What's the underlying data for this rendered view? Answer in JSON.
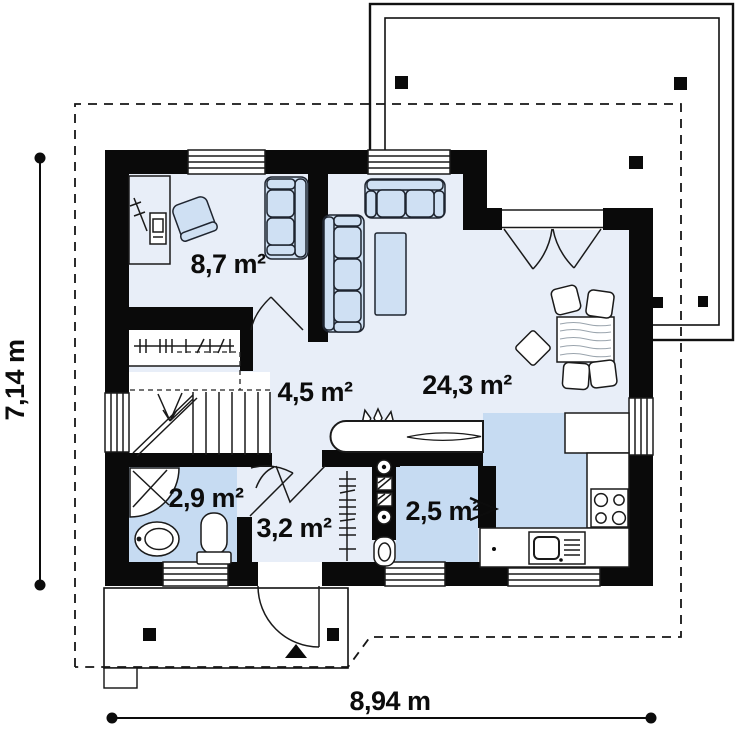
{
  "plan": {
    "type": "floor-plan",
    "rooms": [
      {
        "id": "office",
        "area_label": "8,7 m²"
      },
      {
        "id": "hall",
        "area_label": "4,5 m²"
      },
      {
        "id": "living-room",
        "area_label": "24,3 m²"
      },
      {
        "id": "bathroom",
        "area_label": "2,9 m²"
      },
      {
        "id": "vestibule",
        "area_label": "3,2 m²"
      },
      {
        "id": "pantry",
        "area_label": "2,5 m²"
      }
    ],
    "dimensions": {
      "height_label": "7,14 m",
      "width_label": "8,94 m"
    },
    "colors": {
      "wall": "#0a0a0a",
      "floor_light": "#e8eef8",
      "floor_medium": "#c6dbf2",
      "furniture_fill": "#cfe0f3",
      "line": "#1a1a1a",
      "background": "#ffffff"
    }
  }
}
